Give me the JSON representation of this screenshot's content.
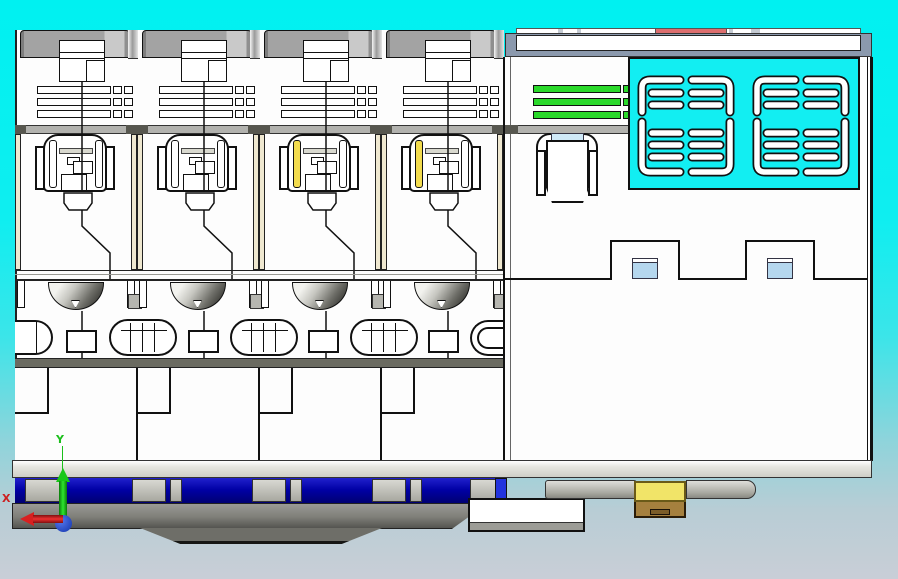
{
  "viewport": {
    "description": "CAD viewport: side section view of a 4-pole DIN-rail circuit breaker with auxiliary vented module",
    "background_top_color": "#00f1f1",
    "background_bottom_color": "#c9ced7"
  },
  "axis_triad": {
    "x_label": "X",
    "y_label": "Y",
    "x_color": "#cc2020",
    "y_color": "#1bbf1b",
    "origin_color": "#2244bb"
  },
  "device": {
    "module_count": 4,
    "modules": [
      {
        "name": "pole-1",
        "indicator_color": "#ffffff"
      },
      {
        "name": "pole-2",
        "indicator_color": "#ffffff"
      },
      {
        "name": "pole-3",
        "indicator_color": "#f3dc4e"
      },
      {
        "name": "pole-4",
        "indicator_color": "#f3dc4e"
      }
    ],
    "colors": {
      "cap_gray": "#a3a3a3",
      "body_white": "#fdfdfd",
      "divider_cream": "#efe8d0",
      "band_olive": "#6b6b61",
      "rail_blue": "#0000a5",
      "base_gray": "#8e8e88",
      "green_bar": "#2bd92b",
      "red_strip": "#dc6e6e",
      "frame_slate": "#8b99ad",
      "vent_cyan": "#12eef2",
      "tab_blue": "#b5d7ee",
      "arch_blue": "#cfe9f8",
      "clip_yellow": "#f1e468",
      "clip_brown": "#a5803e"
    },
    "green_bar_count": 3,
    "vent_panel": {
      "groups": 2,
      "columns_per_group": 2,
      "slots_per_column": 7
    }
  }
}
